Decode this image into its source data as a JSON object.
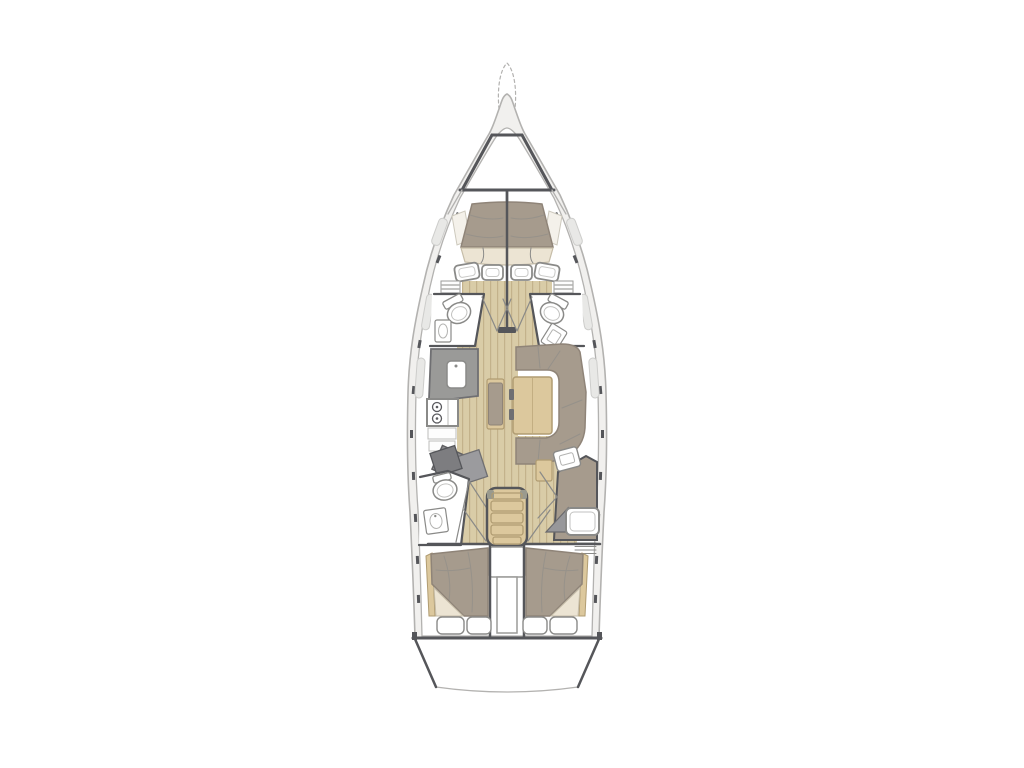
{
  "theme": {
    "css_vars": "--bg:#ffffff;--white:#ffffff;--hull-line:#b3b2b0;--dark:#55565a;--deck:#f1f0ee;--wood:#d9cca7;--wood-line:#c3b28b;--wood-furn:#dcc89d;--wood-furn-line:#b09c72;--uphol:#a69b8d;--uphol-dark:#8f8478;--cream:#ece4d3;--cream-line:#c6bda8;--gray-counter:#9a9a98;--gray-dark:#7d7d80;--fixture-line:#8a8a88",
    "background": "#ffffff"
  },
  "diagram": {
    "type": "yacht-interior-floor-plan",
    "orientation": "bow-up"
  }
}
